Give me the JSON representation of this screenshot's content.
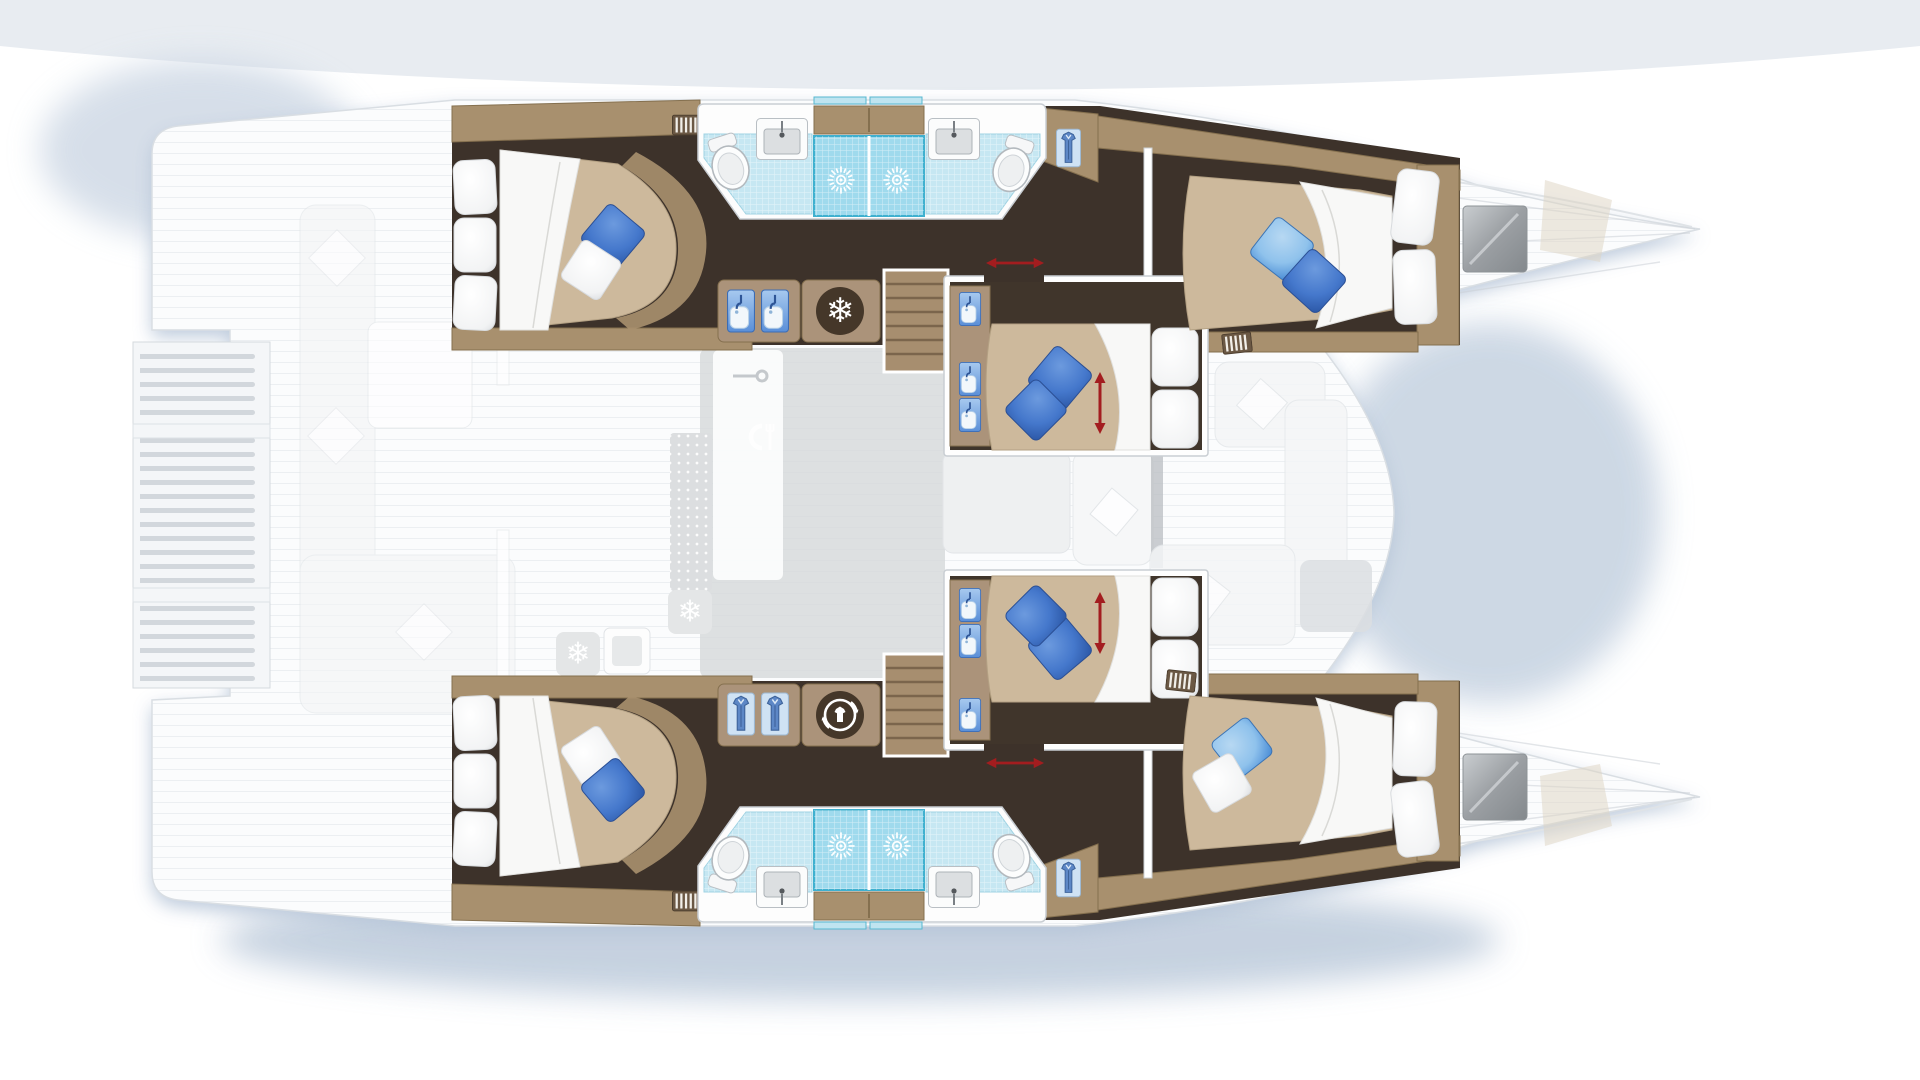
{
  "diagram": {
    "type": "catamaran-deck-plan",
    "view": "top-down floor plan, bows pointing right",
    "vessel": "sailing catamaran, 6-cabin layout",
    "cabins": [
      {
        "id": "upper-aft-cabin",
        "hull": "upper",
        "position": "aft",
        "bed": "island double",
        "pillows": [
          "blue",
          "white"
        ],
        "features": [
          "blind-vent"
        ]
      },
      {
        "id": "upper-forward-cabin",
        "hull": "upper",
        "position": "forward",
        "bed": "island double",
        "pillows": [
          "light-blue",
          "blue"
        ],
        "features": [
          "tv-screen",
          "blind-vent",
          "wardrobe"
        ]
      },
      {
        "id": "upper-mid-cabin",
        "hull": "nacelle",
        "position": "midship upper",
        "bed": "sliding double",
        "pillows": [
          "blue",
          "blue"
        ],
        "features": [
          "vanity-basins",
          "sliding-bed-arrow",
          "sliding-door-arrow"
        ]
      },
      {
        "id": "lower-mid-cabin",
        "hull": "nacelle",
        "position": "midship lower",
        "bed": "sliding double",
        "pillows": [
          "blue",
          "blue"
        ],
        "features": [
          "vanity-basins",
          "sliding-bed-arrow",
          "sliding-door-arrow"
        ]
      },
      {
        "id": "lower-aft-cabin",
        "hull": "lower",
        "position": "aft",
        "bed": "island double",
        "pillows": [
          "white",
          "blue"
        ],
        "features": [
          "wardrobe-shirts",
          "washing-machine",
          "blind-vent"
        ]
      },
      {
        "id": "lower-forward-cabin",
        "hull": "lower",
        "position": "forward",
        "bed": "island double",
        "pillows": [
          "light-blue",
          "white"
        ],
        "features": [
          "tv-screen",
          "blind-vent",
          "wardrobe"
        ]
      }
    ],
    "bathrooms": [
      {
        "id": "upper-bathroom",
        "hull": "upper",
        "fixtures": [
          "toilet",
          "washbasin",
          "shower",
          "shower",
          "washbasin",
          "toilet"
        ],
        "floor": "light-blue mosaic tile"
      },
      {
        "id": "lower-bathroom",
        "hull": "lower",
        "fixtures": [
          "toilet",
          "washbasin",
          "shower",
          "shower",
          "washbasin",
          "toilet"
        ],
        "floor": "light-blue mosaic tile"
      }
    ],
    "galley": {
      "upper-cabinet": [
        "basin",
        "basin",
        "freezer"
      ],
      "lower-cabinet": [
        "shirt-locker",
        "shirt-locker",
        "washing-machine"
      ],
      "saloon-faded": [
        "sink",
        "dining-icon",
        "drainer-mat",
        "fridge",
        "fridge"
      ]
    },
    "deck": [
      "swim-platform-slats",
      "aft-cockpit-bench",
      "cockpit-table",
      "saloon-dinette",
      "foredeck-seating",
      "bow-decks"
    ],
    "stairs": 2,
    "tv_screens": 2
  },
  "icons": {
    "snowflake": "❄",
    "names": [
      "shower-spray-icon",
      "basin-icon",
      "shirt-icon",
      "toilet-icon",
      "washbasin-icon",
      "freezer-icon",
      "washing-machine-icon",
      "blind-vent-icon",
      "dining-icon",
      "bed-slide-arrow",
      "door-slide-arrow",
      "tv-screen"
    ]
  },
  "palette": {
    "floor_dark": "#3d322a",
    "wood": "#a8906e",
    "mattress": "#cdb99c",
    "duvet": "#f8f8f7",
    "pillow_blue": "#4578cc",
    "pillow_light_blue": "#8fc2ec",
    "tile": "#c6e7f2",
    "shower": "#9fdaed",
    "glass": "#3fb0cf",
    "arrow_red": "#a31d1f",
    "hull_white": "#fbfcfd",
    "shadow_blue": "#b6c5d8",
    "tv_gray": "#9b9fa3"
  }
}
